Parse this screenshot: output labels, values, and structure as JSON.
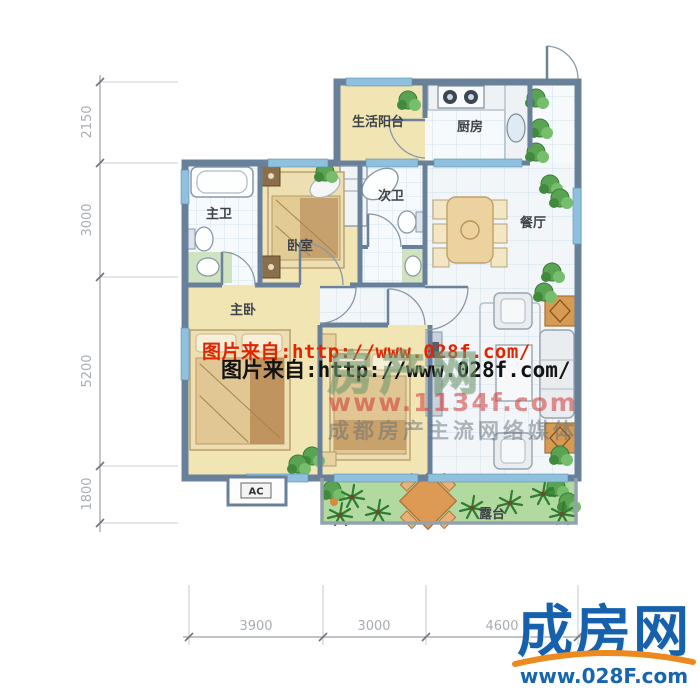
{
  "plan": {
    "rooms": [
      {
        "id": "balcony",
        "label": "生活阳台"
      },
      {
        "id": "kitchen",
        "label": "厨房"
      },
      {
        "id": "master-bath",
        "label": "主卫"
      },
      {
        "id": "bedroom",
        "label": "卧室"
      },
      {
        "id": "second-bath",
        "label": "次卫"
      },
      {
        "id": "dining",
        "label": "餐厅"
      },
      {
        "id": "master-bedroom",
        "label": "主卧"
      },
      {
        "id": "terrace",
        "label": "露台"
      }
    ],
    "ac_label": "AC"
  },
  "dimensions": {
    "left": [
      "2150",
      "3000",
      "5200",
      "1800"
    ],
    "bottom": [
      "3900",
      "3000",
      "4600"
    ]
  },
  "watermarks": {
    "red_text": "图片来自:http://www.028f.com/",
    "black_text": "图片来自:http://www.028f.com/",
    "center": {
      "big_text": "房产网",
      "url": "www.1134f.com",
      "slogan": "成都房产主流网络媒体"
    },
    "logo": {
      "name": "成房网",
      "url": "www.028F.com"
    }
  },
  "colors": {
    "wall": "#69809a",
    "floor_yellow": "#f1e5b4",
    "floor_tile": "#f7fafc",
    "terrace_green": "#b2d9a0",
    "window_blue": "#8fc0dd",
    "logo_blue": "#1660ac",
    "logo_orange": "#ec8a1f",
    "watermark_red": "#e32400"
  }
}
